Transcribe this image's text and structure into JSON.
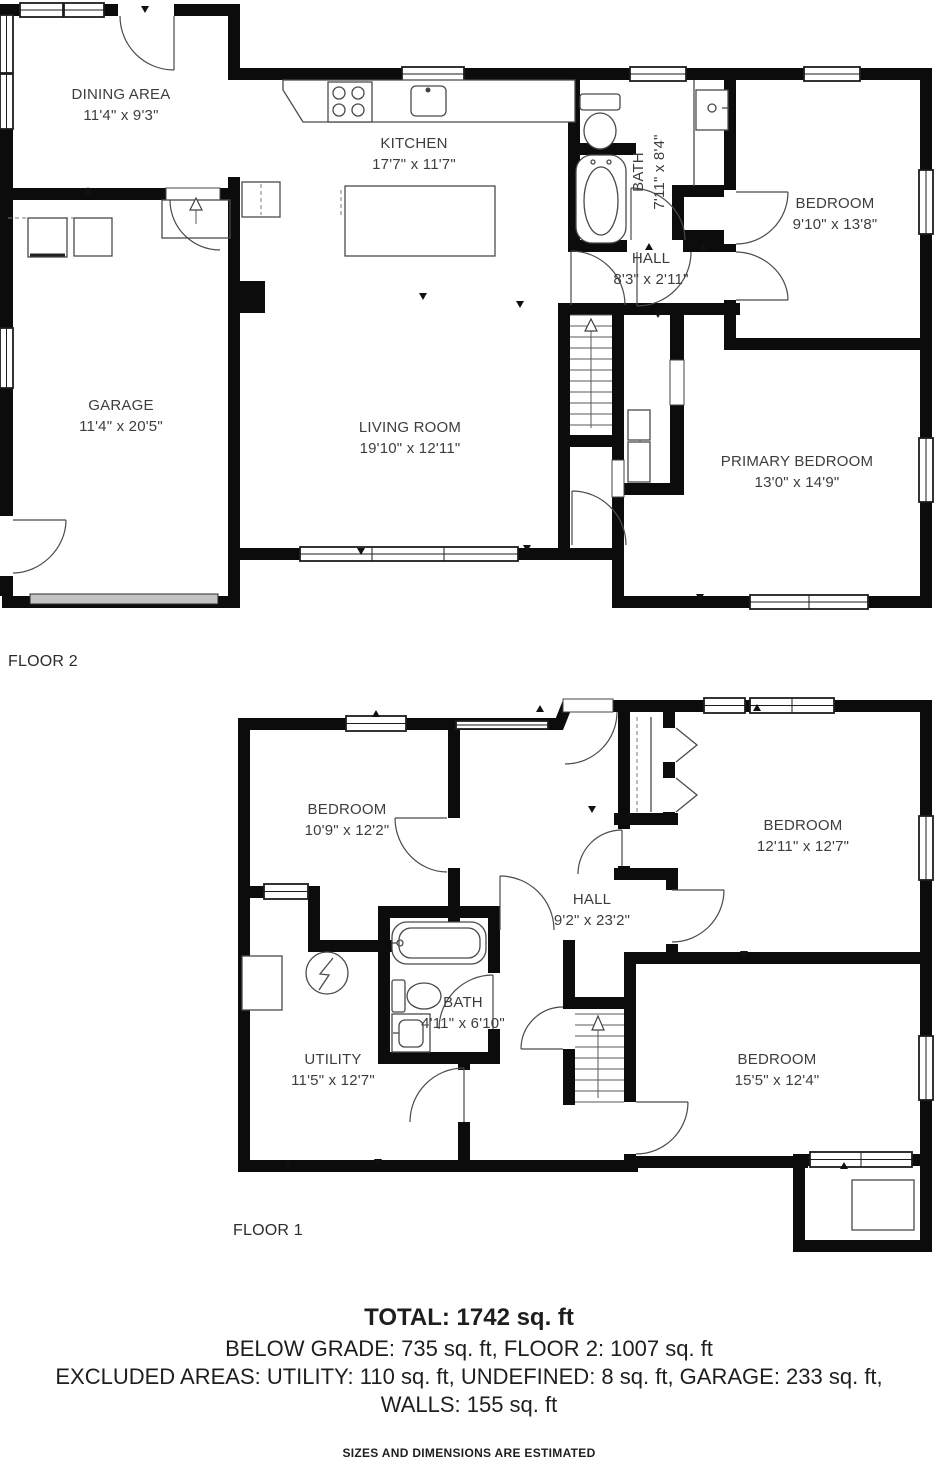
{
  "floors": [
    {
      "label": "FLOOR 2",
      "rooms": [
        {
          "name": "DINING AREA",
          "dims": "11'4\" x 9'3\""
        },
        {
          "name": "KITCHEN",
          "dims": "17'7\" x 11'7\""
        },
        {
          "name": "BATH",
          "dims": "7'11\" x 8'4\""
        },
        {
          "name": "HALL",
          "dims": "8'3\" x 2'11\""
        },
        {
          "name": "BEDROOM",
          "dims": "9'10\" x 13'8\""
        },
        {
          "name": "GARAGE",
          "dims": "11'4\" x 20'5\""
        },
        {
          "name": "LIVING ROOM",
          "dims": "19'10\" x 12'11\""
        },
        {
          "name": "PRIMARY BEDROOM",
          "dims": "13'0\" x 14'9\""
        }
      ]
    },
    {
      "label": "FLOOR 1",
      "rooms": [
        {
          "name": "BEDROOM",
          "dims": "10'9\" x 12'2\""
        },
        {
          "name": "HALL",
          "dims": "9'2\" x 23'2\""
        },
        {
          "name": "BEDROOM",
          "dims": "12'11\" x 12'7\""
        },
        {
          "name": "BATH",
          "dims": "4'11\" x 6'10\""
        },
        {
          "name": "UTILITY",
          "dims": "11'5\" x 12'7\""
        },
        {
          "name": "BEDROOM",
          "dims": "15'5\" x 12'4\""
        }
      ]
    }
  ],
  "summary": {
    "total": "TOTAL: 1742 sq. ft",
    "line2": "BELOW GRADE: 735 sq. ft, FLOOR 2: 1007 sq. ft",
    "line3": "EXCLUDED AREAS: UTILITY: 110 sq. ft, UNDEFINED: 8 sq. ft, GARAGE: 233 sq. ft,",
    "line4": "WALLS: 155 sq. ft",
    "disclaimer": "SIZES AND DIMENSIONS ARE ESTIMATED"
  }
}
